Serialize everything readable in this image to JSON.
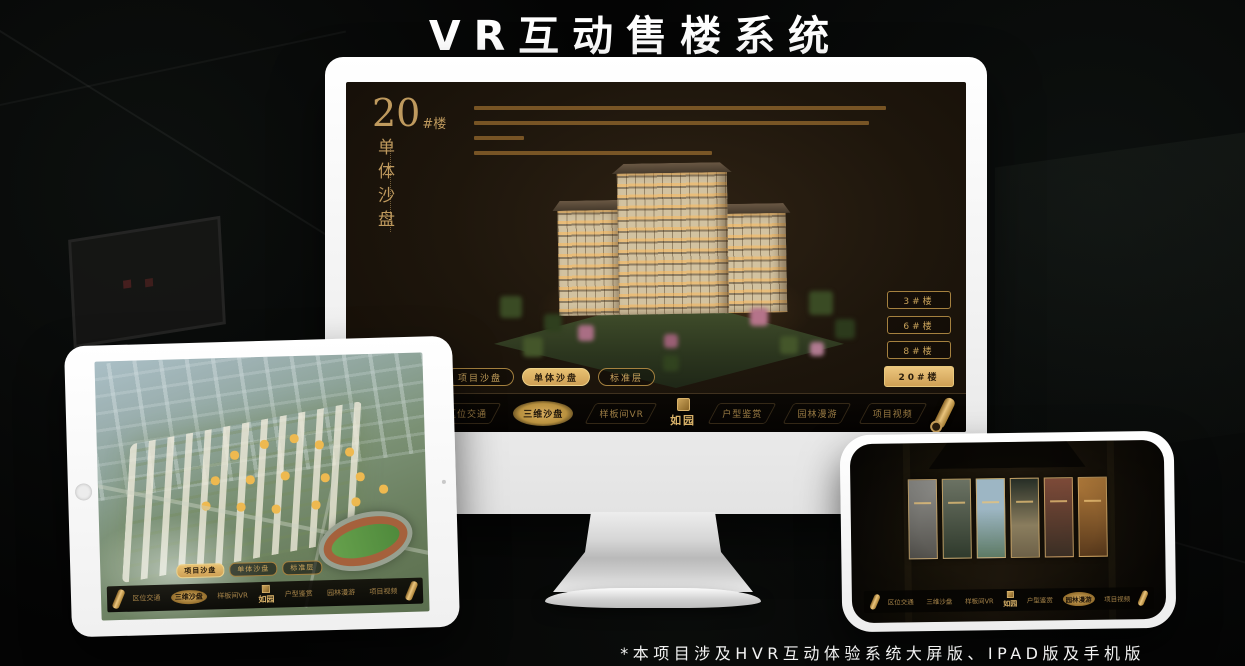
{
  "title": "VR互动售楼系统",
  "footnote": "*本项目涉及HVR互动体验系统大屏版、IPAD版及手机版",
  "colors": {
    "gold": "#c9a05a",
    "gold_bright": "#ecc67e",
    "screen_bg": "#1e160c",
    "headline_text": "#bf9a5e"
  },
  "monitor": {
    "headline": {
      "number": "20",
      "suffix": "#楼",
      "subtitle_vertical": "单体沙盘"
    },
    "floor_buttons": [
      {
        "label": "3#楼",
        "active": false
      },
      {
        "label": "6#楼",
        "active": false
      },
      {
        "label": "8#楼",
        "active": false
      },
      {
        "label": "20#楼",
        "active": true
      }
    ],
    "sub_tabs": [
      {
        "label": "项目沙盘",
        "active": false
      },
      {
        "label": "单体沙盘",
        "active": true
      },
      {
        "label": "标准层",
        "active": false
      }
    ],
    "nav": {
      "items": [
        {
          "label": "区位交通",
          "active": false
        },
        {
          "label": "三维沙盘",
          "active": true
        },
        {
          "label": "样板间VR",
          "active": false
        },
        {
          "label": "户型鉴赏",
          "active": false
        },
        {
          "label": "园林漫游",
          "active": false
        },
        {
          "label": "项目视频",
          "active": false
        }
      ],
      "logo": "如园"
    }
  },
  "tablet": {
    "sub_tabs": [
      {
        "label": "项目沙盘",
        "active": true
      },
      {
        "label": "单体沙盘",
        "active": false
      },
      {
        "label": "标准层",
        "active": false
      }
    ],
    "nav": {
      "items": [
        {
          "label": "区位交通",
          "active": false
        },
        {
          "label": "三维沙盘",
          "active": true
        },
        {
          "label": "样板间VR",
          "active": false
        },
        {
          "label": "户型鉴赏",
          "active": false
        },
        {
          "label": "园林漫游",
          "active": false
        },
        {
          "label": "项目视频",
          "active": false
        }
      ],
      "logo": "如园"
    }
  },
  "phone": {
    "panels_count": 6,
    "nav": {
      "items": [
        {
          "label": "区位交通",
          "active": false
        },
        {
          "label": "三维沙盘",
          "active": false
        },
        {
          "label": "样板间VR",
          "active": false
        },
        {
          "label": "户型鉴赏",
          "active": false
        },
        {
          "label": "园林漫游",
          "active": true
        },
        {
          "label": "项目视频",
          "active": false
        }
      ],
      "logo": "如园"
    }
  }
}
